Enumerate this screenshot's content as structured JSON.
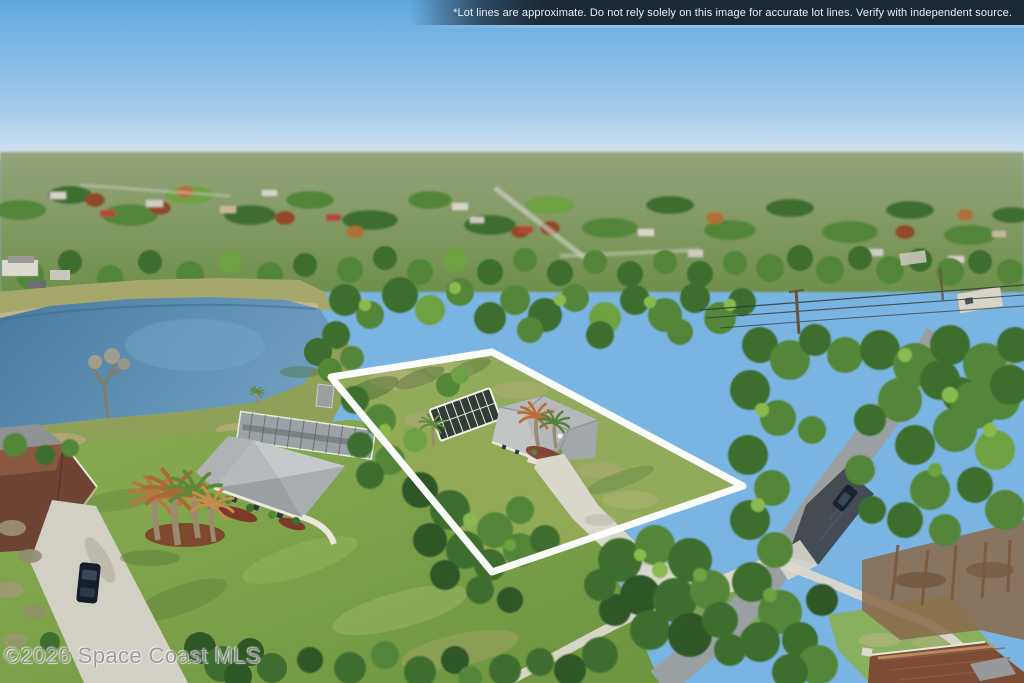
{
  "banner": {
    "text": "*Lot lines are approximate. Do not rely solely on this image for accurate lot lines. Verify with independent source.",
    "background": "#1b2836",
    "text_color": "#e9eff6"
  },
  "watermark": {
    "text": "©2026 Space Coast MLS"
  },
  "lot": {
    "points": "492,352 743,486 492,572 331,377",
    "stroke": "#ffffff",
    "stroke_width": 7
  },
  "palette": {
    "sky_top": "#5fa9e0",
    "sky_mid": "#a6cbea",
    "sky_horizon": "#d6e6f3",
    "water_deep": "#4a7ba0",
    "water_light": "#6d9cc0",
    "lawn_light": "#8aac52",
    "lawn_dark": "#6d9440",
    "lot_grass": "#93aa57",
    "canopy_dark": "#2e5727",
    "canopy_light": "#8ab950",
    "road_gray": "#9aa0a2",
    "asphalt_new": "#3e434a",
    "concrete": "#d9d6cb",
    "roof_gray": "#b6babc",
    "roof_brown": "#7d4c34",
    "mulch_red": "#7e392a",
    "outline_white": "#ffffff"
  }
}
